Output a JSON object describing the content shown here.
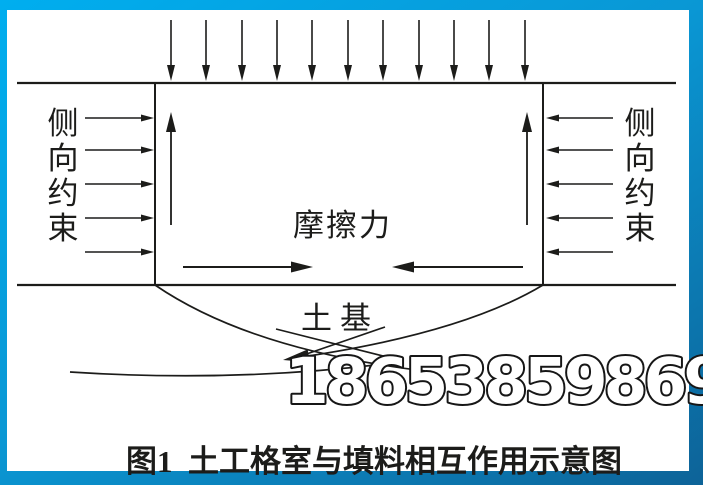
{
  "colors": {
    "frame_top": "#00aeef",
    "frame_mid": "#0a97d4",
    "frame_bottom": "#0d6398",
    "canvas": "#ffffff",
    "ink": "#1c1c1a"
  },
  "diagram": {
    "left_restraint_label": [
      "侧",
      "向",
      "约",
      "束"
    ],
    "right_restraint_label": [
      "侧",
      "向",
      "约",
      "束"
    ],
    "friction_label": "摩擦力",
    "foundation_label": "土基",
    "load_arrow_count": 11,
    "lateral_arrow_count_per_side": 5,
    "uplift_arrow_count": 2,
    "friction_arrow_count": 2
  },
  "watermark": {
    "text": "18653859869"
  },
  "caption": {
    "text": "图1  土工格室与填料相互作用示意图"
  }
}
